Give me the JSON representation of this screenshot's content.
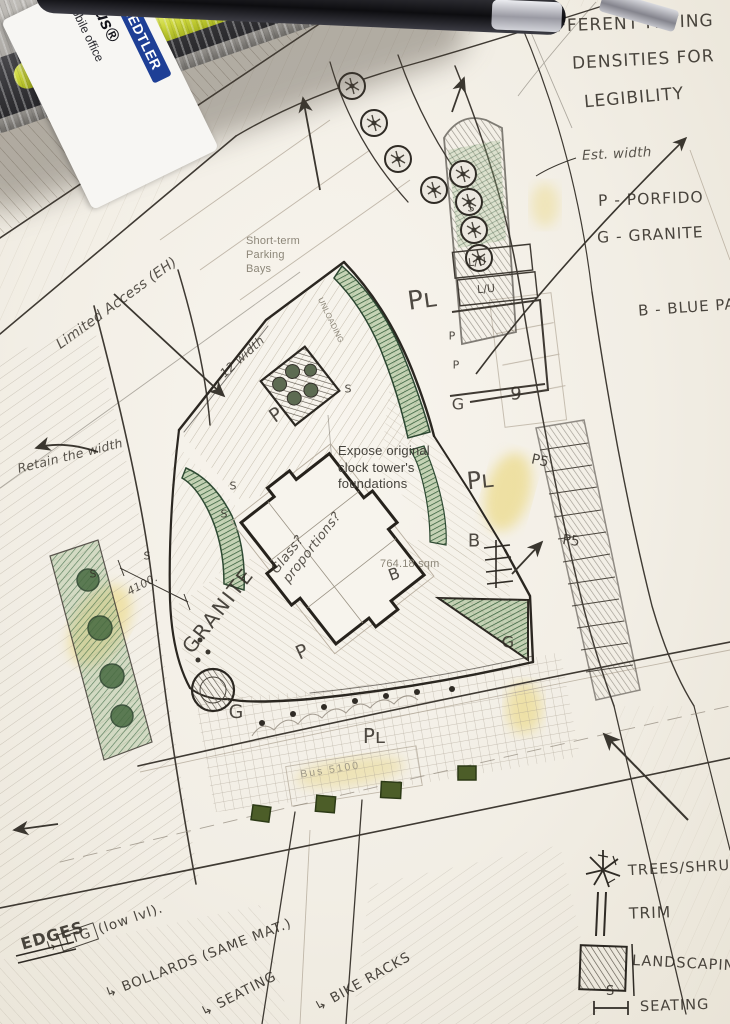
{
  "stationery": {
    "brand": "STAEDTLER",
    "product": "iplus®",
    "tagline": "mobile office"
  },
  "notes": {
    "paving1": "DIFFERENT PAVING",
    "paving2": "DENSITIES FOR",
    "paving3": "LEGIBILITY",
    "est_width": "Est. width",
    "mat_p": "P - PORFIDO",
    "mat_g": "G - GRANITE",
    "mat_b": "B - BLUE PAV",
    "limited_access": "Limited Access (EH)",
    "retain_width": "Retain the width",
    "twelve_width": "12 width",
    "dim_4100": "4100.",
    "granite": "GRANITE",
    "glass1": "Glass?",
    "glass2": "proportions?"
  },
  "printed": {
    "short_term1": "Short-term",
    "short_term2": "Parking",
    "short_term3": "Bays",
    "unloading": "UNLOADING",
    "expose1": "Expose original",
    "expose2": "clock tower's",
    "expose3": "foundations",
    "area": "764.18 sqm",
    "bus": "Bus 5100"
  },
  "edges_legend": {
    "title": "EDGES",
    "arrow": "↳",
    "ltg": "LTG",
    "ltg_suffix": "(low lvl).",
    "bollards": "BOLLARDS (SAME MAT.)",
    "seating": "SEATING",
    "bike_racks": "BIKE RACKS"
  },
  "symbols_legend": {
    "trees": "TREES/SHRUBS",
    "trim": "TRIM",
    "landscaping": "LANDSCAPING",
    "seating": "SEATING",
    "seating_symbol": "S"
  },
  "markers": [
    {
      "t": "Pʟ",
      "x": 422,
      "y": 300,
      "r": -8,
      "s": 26
    },
    {
      "t": "Pʟ",
      "x": 480,
      "y": 480,
      "r": -6,
      "s": 24
    },
    {
      "t": "Pʟ",
      "x": 374,
      "y": 736,
      "r": 0,
      "s": 20
    },
    {
      "t": "P",
      "x": 276,
      "y": 415,
      "r": -35,
      "s": 19
    },
    {
      "t": "P",
      "x": 302,
      "y": 652,
      "r": -25,
      "s": 19
    },
    {
      "t": "P",
      "x": 452,
      "y": 336,
      "r": 0,
      "s": 11
    },
    {
      "t": "P",
      "x": 456,
      "y": 365,
      "r": 0,
      "s": 11
    },
    {
      "t": "G",
      "x": 458,
      "y": 404,
      "r": 0,
      "s": 16
    },
    {
      "t": "9",
      "x": 516,
      "y": 394,
      "r": 0,
      "s": 18
    },
    {
      "t": "G",
      "x": 236,
      "y": 712,
      "r": 0,
      "s": 19
    },
    {
      "t": "G",
      "x": 508,
      "y": 642,
      "r": 0,
      "s": 16
    },
    {
      "t": "B",
      "x": 474,
      "y": 541,
      "r": 0,
      "s": 18
    },
    {
      "t": "B",
      "x": 394,
      "y": 574,
      "r": -20,
      "s": 16
    },
    {
      "t": "P5",
      "x": 540,
      "y": 461,
      "r": 12,
      "s": 14
    },
    {
      "t": "P5",
      "x": 571,
      "y": 541,
      "r": 8,
      "s": 14
    },
    {
      "t": "L/U",
      "x": 477,
      "y": 262,
      "r": -5,
      "s": 11
    },
    {
      "t": "L/U",
      "x": 486,
      "y": 289,
      "r": -5,
      "s": 11
    },
    {
      "t": "S",
      "x": 348,
      "y": 389,
      "r": 0,
      "s": 11
    },
    {
      "t": "S",
      "x": 471,
      "y": 208,
      "r": 0,
      "s": 11
    },
    {
      "t": "S",
      "x": 233,
      "y": 486,
      "r": 0,
      "s": 11
    },
    {
      "t": "S",
      "x": 224,
      "y": 514,
      "r": 0,
      "s": 11
    },
    {
      "t": "S",
      "x": 147,
      "y": 556,
      "r": 0,
      "s": 11
    },
    {
      "t": "S",
      "x": 93,
      "y": 574,
      "r": 0,
      "s": 11
    }
  ],
  "colors": {
    "pencil": "#3a362f",
    "green": "#3f6a45",
    "paper": "#f3f0e9",
    "brand_blue": "#1e3f96",
    "highlighter": "#ccd63c"
  }
}
